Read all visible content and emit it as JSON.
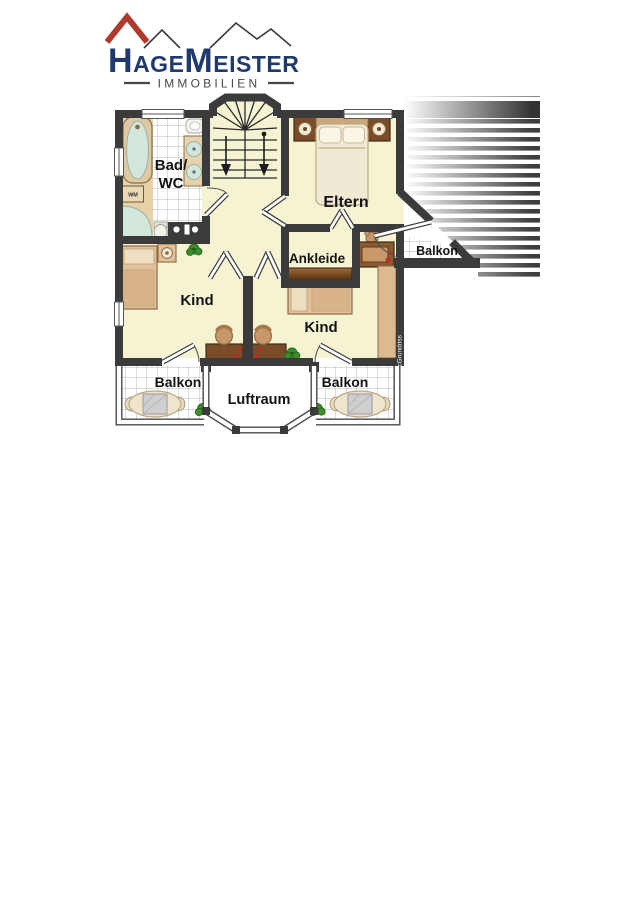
{
  "page": {
    "background": "#ffffff"
  },
  "logo": {
    "brand": {
      "h": "H",
      "age": "AGE",
      "m": "M",
      "eister": "EISTER"
    },
    "subtitle": "IMMOBILIEN",
    "colors": {
      "navy": "#203a6d",
      "roof_red": "#b0392e",
      "subtitle_gray": "#474747"
    }
  },
  "floorplan": {
    "labels": {
      "bad_wc_line1": "Bad/",
      "bad_wc_line2": "WC",
      "eltern": "Eltern",
      "ankleide": "Ankleide",
      "kind_left": "Kind",
      "kind_right": "Kind",
      "balkon_top": "Balkon",
      "balkon_bottom_left": "Balkon",
      "balkon_bottom_right": "Balkon",
      "luftraum": "Luftraum",
      "washing_machine": "WM",
      "watermark": "McGrundriss"
    },
    "colors": {
      "wall": "#3b3b3b",
      "floor": "#f6f3d3",
      "tile_line": "#b9b9b9",
      "furniture_tan": "#ddbd92",
      "wood_dark": "#7a4c28",
      "linen": "#f0e9d4",
      "plant_green": "#3e8e2c",
      "accent_red": "#b62f28",
      "water_blue": "#d3e6da"
    }
  }
}
